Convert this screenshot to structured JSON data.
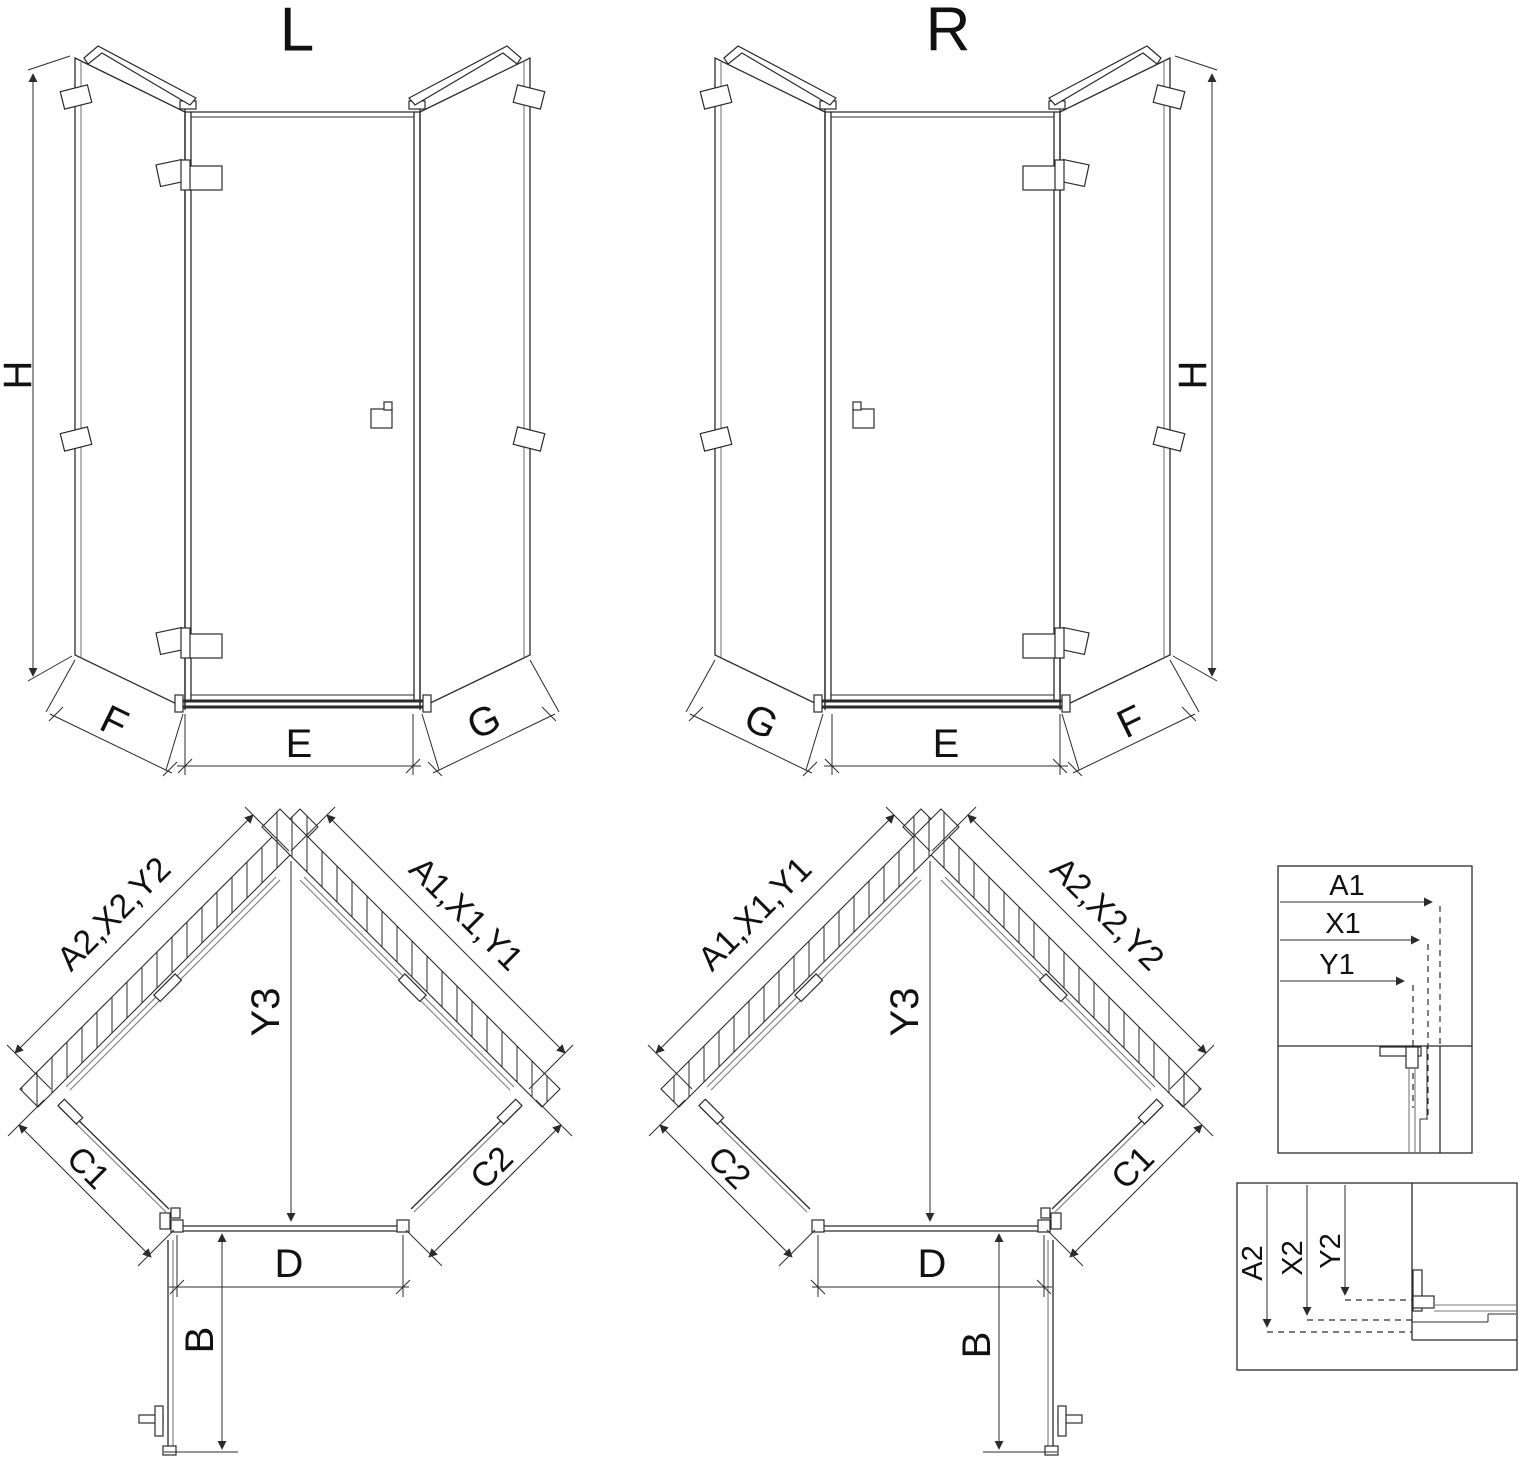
{
  "drawing": {
    "elevation_left": {
      "title": "L",
      "height": "H",
      "bottom_left": "F",
      "bottom_center": "E",
      "bottom_right": "G"
    },
    "elevation_right": {
      "title": "R",
      "height": "H",
      "bottom_left": "G",
      "bottom_center": "E",
      "bottom_right": "F"
    },
    "plan_left": {
      "wall_upper_left": "A2,X2,Y2",
      "wall_upper_right": "A1,X1,Y1",
      "depth": "Y3",
      "side_lower_left": "C1",
      "side_lower_right": "C2",
      "front_width": "D",
      "door_projection": "B"
    },
    "plan_right": {
      "wall_upper_left": "A1,X1,Y1",
      "wall_upper_right": "A2,X2,Y2",
      "depth": "Y3",
      "side_lower_left": "C2",
      "side_lower_right": "C1",
      "front_width": "D",
      "door_projection": "B"
    },
    "detail_top": {
      "dims": [
        "A1",
        "X1",
        "Y1"
      ]
    },
    "detail_bottom": {
      "dims": [
        "A2",
        "X2",
        "Y2"
      ]
    }
  },
  "colors": {
    "line": "#2b2b2b",
    "glass": "#7a7a7a",
    "text": "#111111",
    "background": "#ffffff"
  }
}
